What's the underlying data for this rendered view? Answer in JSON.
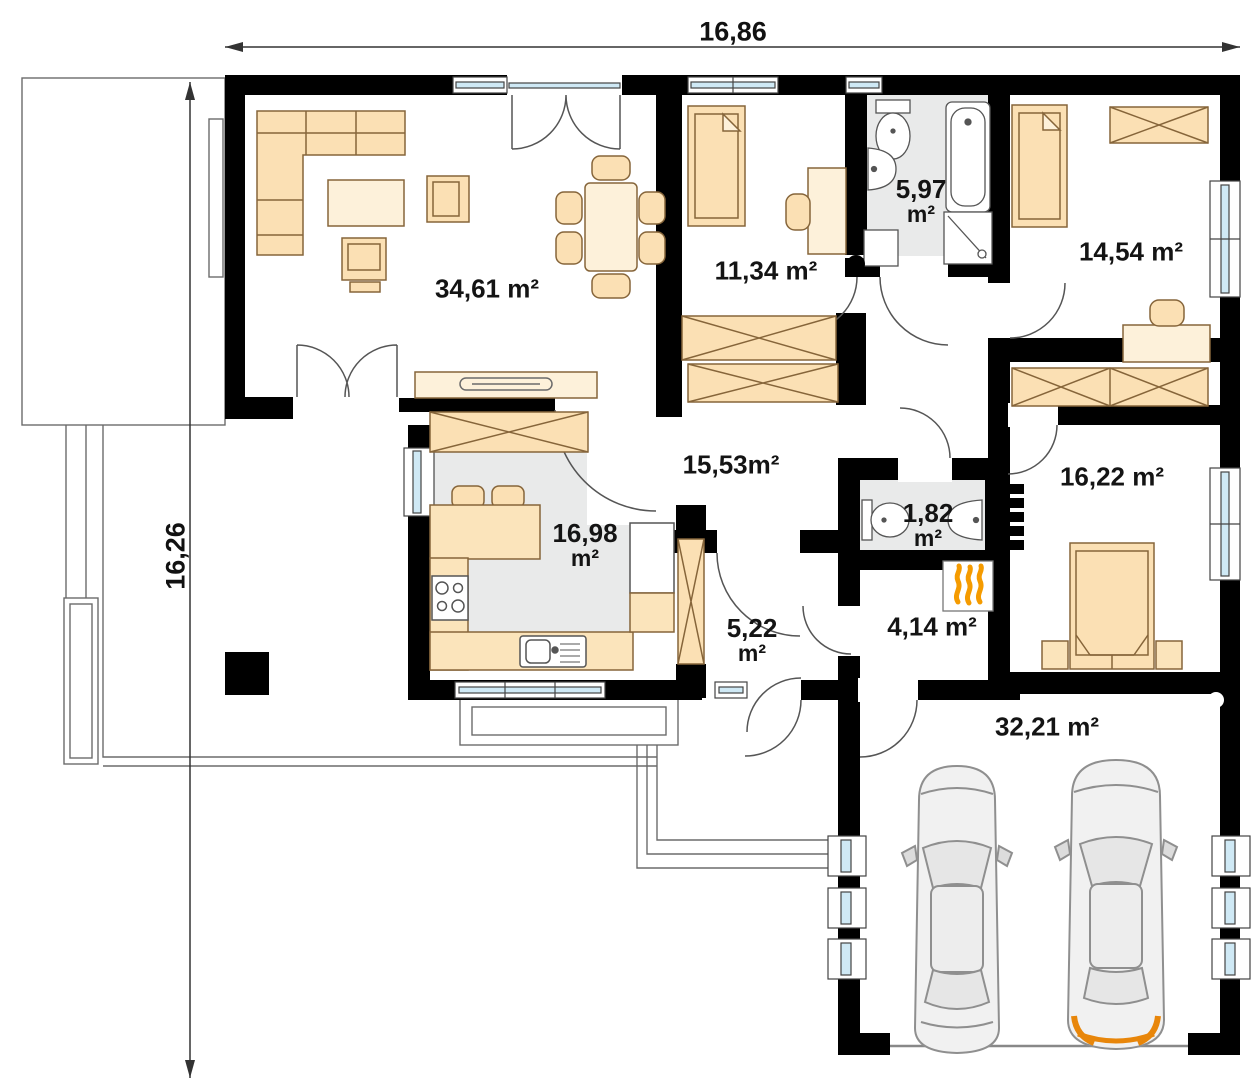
{
  "dimensions": {
    "width_label": "16,86",
    "height_label": "16,26"
  },
  "rooms": {
    "living_room": {
      "value": "34,61",
      "unit": "m²"
    },
    "bedroom_top": {
      "value": "11,34",
      "unit": "m²"
    },
    "bathroom": {
      "value": "5,97",
      "unit": "m²"
    },
    "bedroom_right": {
      "value": "14,54",
      "unit": "m²"
    },
    "hall": {
      "value": "15,53",
      "unit": "m²"
    },
    "kitchen": {
      "value": "16,98",
      "unit": "m²"
    },
    "bedroom_master": {
      "value": "16,22",
      "unit": "m²"
    },
    "wc": {
      "value": "1,82",
      "unit": "m²"
    },
    "entry": {
      "value": "5,22",
      "unit": "m²"
    },
    "boiler_room": {
      "value": "4,14",
      "unit": "m²"
    },
    "garage": {
      "value": "32,21",
      "unit": "m²"
    }
  },
  "colors": {
    "wall": "#000000",
    "glass": "#cfe9f5",
    "furniture": "#fbe0b4",
    "furniture_light": "#fdf1da",
    "floor_grey": "#e9eaea",
    "flame_accent": "#f59b00",
    "car_accent": "#e8860a"
  }
}
